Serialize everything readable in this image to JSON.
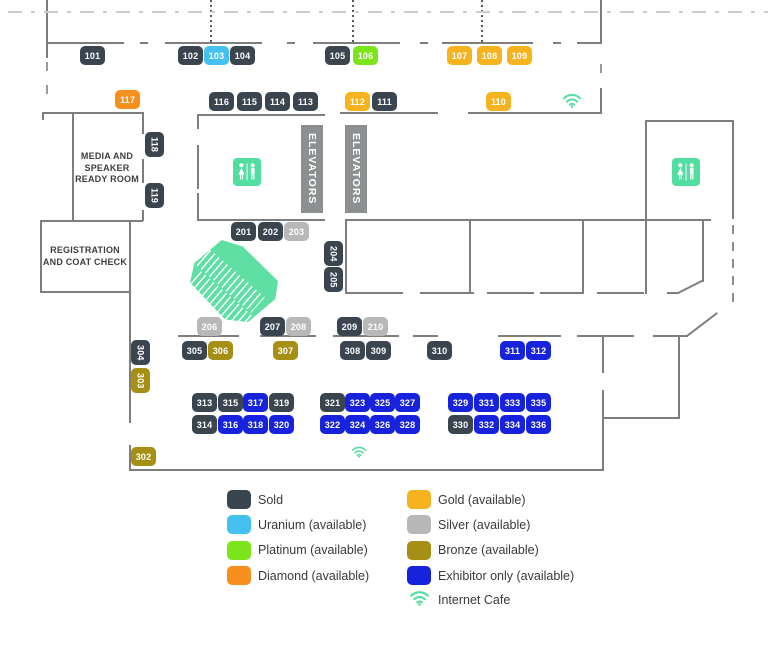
{
  "tiers": {
    "sold": {
      "label": "Sold",
      "color": "#3A4550"
    },
    "uranium": {
      "label": "Uranium (available)",
      "color": "#45C1F0"
    },
    "platinum": {
      "label": "Platinum (available)",
      "color": "#7CE41B"
    },
    "diamond": {
      "label": "Diamond (available)",
      "color": "#F78F1E"
    },
    "gold": {
      "label": "Gold (available)",
      "color": "#F5B31F"
    },
    "silver": {
      "label": "Silver (available)",
      "color": "#B8B8B8"
    },
    "bronze": {
      "label": "Bronze (available)",
      "color": "#A58F14"
    },
    "exhibitor": {
      "label": "Exhibitor only (available)",
      "color": "#1722DD"
    }
  },
  "legend": {
    "left_items": [
      "sold",
      "uranium",
      "platinum",
      "diamond"
    ],
    "right_items": [
      "gold",
      "silver",
      "bronze",
      "exhibitor"
    ],
    "internet_cafe_label": "Internet Cafe"
  },
  "rooms": {
    "media_lines": [
      "MEDIA AND",
      "SPEAKER",
      "READY ROOM"
    ],
    "registration_lines": [
      "REGISTRATION",
      "AND COAT CHECK"
    ],
    "elevators_label": "ELEVATORS"
  },
  "icons": {
    "teal": "#52DEA0",
    "wifi": "internet-cafe-wifi",
    "restroom": "restroom"
  },
  "booths": [
    {
      "n": "101",
      "t": "sold",
      "x": 80,
      "y": 46
    },
    {
      "n": "102",
      "t": "sold",
      "x": 178,
      "y": 46
    },
    {
      "n": "103",
      "t": "uranium",
      "x": 204,
      "y": 46
    },
    {
      "n": "104",
      "t": "sold",
      "x": 230,
      "y": 46
    },
    {
      "n": "105",
      "t": "sold",
      "x": 325,
      "y": 46
    },
    {
      "n": "106",
      "t": "platinum",
      "x": 353,
      "y": 46
    },
    {
      "n": "107",
      "t": "gold",
      "x": 447,
      "y": 46
    },
    {
      "n": "108",
      "t": "gold",
      "x": 477,
      "y": 46
    },
    {
      "n": "109",
      "t": "gold",
      "x": 507,
      "y": 46
    },
    {
      "n": "117",
      "t": "diamond",
      "x": 115,
      "y": 90
    },
    {
      "n": "116",
      "t": "sold",
      "x": 209,
      "y": 92
    },
    {
      "n": "115",
      "t": "sold",
      "x": 237,
      "y": 92
    },
    {
      "n": "114",
      "t": "sold",
      "x": 265,
      "y": 92
    },
    {
      "n": "113",
      "t": "sold",
      "x": 293,
      "y": 92
    },
    {
      "n": "112",
      "t": "gold",
      "x": 345,
      "y": 92
    },
    {
      "n": "111",
      "t": "sold",
      "x": 372,
      "y": 92
    },
    {
      "n": "110",
      "t": "gold",
      "x": 486,
      "y": 92
    },
    {
      "n": "118",
      "t": "sold",
      "x": 145,
      "y": 132,
      "v": 1
    },
    {
      "n": "119",
      "t": "sold",
      "x": 145,
      "y": 183,
      "v": 1
    },
    {
      "n": "201",
      "t": "sold",
      "x": 231,
      "y": 222
    },
    {
      "n": "202",
      "t": "sold",
      "x": 258,
      "y": 222
    },
    {
      "n": "203",
      "t": "silver",
      "x": 284,
      "y": 222
    },
    {
      "n": "204",
      "t": "sold",
      "x": 324,
      "y": 241,
      "v": 1
    },
    {
      "n": "205",
      "t": "sold",
      "x": 324,
      "y": 267,
      "v": 1
    },
    {
      "n": "206",
      "t": "silver",
      "x": 197,
      "y": 317
    },
    {
      "n": "207",
      "t": "sold",
      "x": 260,
      "y": 317
    },
    {
      "n": "208",
      "t": "silver",
      "x": 286,
      "y": 317
    },
    {
      "n": "209",
      "t": "sold",
      "x": 337,
      "y": 317
    },
    {
      "n": "210",
      "t": "silver",
      "x": 363,
      "y": 317
    },
    {
      "n": "304",
      "t": "sold",
      "x": 131,
      "y": 340,
      "v": 1
    },
    {
      "n": "303",
      "t": "bronze",
      "x": 131,
      "y": 368,
      "v": 1
    },
    {
      "n": "305",
      "t": "sold",
      "x": 182,
      "y": 341
    },
    {
      "n": "306",
      "t": "bronze",
      "x": 208,
      "y": 341
    },
    {
      "n": "307",
      "t": "bronze",
      "x": 273,
      "y": 341
    },
    {
      "n": "308",
      "t": "sold",
      "x": 340,
      "y": 341
    },
    {
      "n": "309",
      "t": "sold",
      "x": 366,
      "y": 341
    },
    {
      "n": "310",
      "t": "sold",
      "x": 427,
      "y": 341
    },
    {
      "n": "311",
      "t": "exhibitor",
      "x": 500,
      "y": 341
    },
    {
      "n": "312",
      "t": "exhibitor",
      "x": 526,
      "y": 341
    },
    {
      "n": "302",
      "t": "bronze",
      "x": 131,
      "y": 447
    },
    {
      "n": "313",
      "t": "sold",
      "x": 192,
      "y": 393
    },
    {
      "n": "315",
      "t": "sold",
      "x": 218,
      "y": 393
    },
    {
      "n": "317",
      "t": "exhibitor",
      "x": 243,
      "y": 393
    },
    {
      "n": "319",
      "t": "sold",
      "x": 269,
      "y": 393
    },
    {
      "n": "314",
      "t": "sold",
      "x": 192,
      "y": 415
    },
    {
      "n": "316",
      "t": "exhibitor",
      "x": 218,
      "y": 415
    },
    {
      "n": "318",
      "t": "exhibitor",
      "x": 243,
      "y": 415
    },
    {
      "n": "320",
      "t": "exhibitor",
      "x": 269,
      "y": 415
    },
    {
      "n": "321",
      "t": "sold",
      "x": 320,
      "y": 393
    },
    {
      "n": "323",
      "t": "exhibitor",
      "x": 345,
      "y": 393
    },
    {
      "n": "325",
      "t": "exhibitor",
      "x": 370,
      "y": 393
    },
    {
      "n": "327",
      "t": "exhibitor",
      "x": 395,
      "y": 393
    },
    {
      "n": "322",
      "t": "exhibitor",
      "x": 320,
      "y": 415
    },
    {
      "n": "324",
      "t": "exhibitor",
      "x": 345,
      "y": 415
    },
    {
      "n": "326",
      "t": "exhibitor",
      "x": 370,
      "y": 415
    },
    {
      "n": "328",
      "t": "exhibitor",
      "x": 395,
      "y": 415
    },
    {
      "n": "329",
      "t": "exhibitor",
      "x": 448,
      "y": 393
    },
    {
      "n": "331",
      "t": "exhibitor",
      "x": 474,
      "y": 393
    },
    {
      "n": "333",
      "t": "exhibitor",
      "x": 500,
      "y": 393
    },
    {
      "n": "335",
      "t": "exhibitor",
      "x": 526,
      "y": 393
    },
    {
      "n": "330",
      "t": "sold",
      "x": 448,
      "y": 415
    },
    {
      "n": "332",
      "t": "exhibitor",
      "x": 474,
      "y": 415
    },
    {
      "n": "334",
      "t": "exhibitor",
      "x": 500,
      "y": 415
    },
    {
      "n": "336",
      "t": "exhibitor",
      "x": 526,
      "y": 415
    }
  ]
}
